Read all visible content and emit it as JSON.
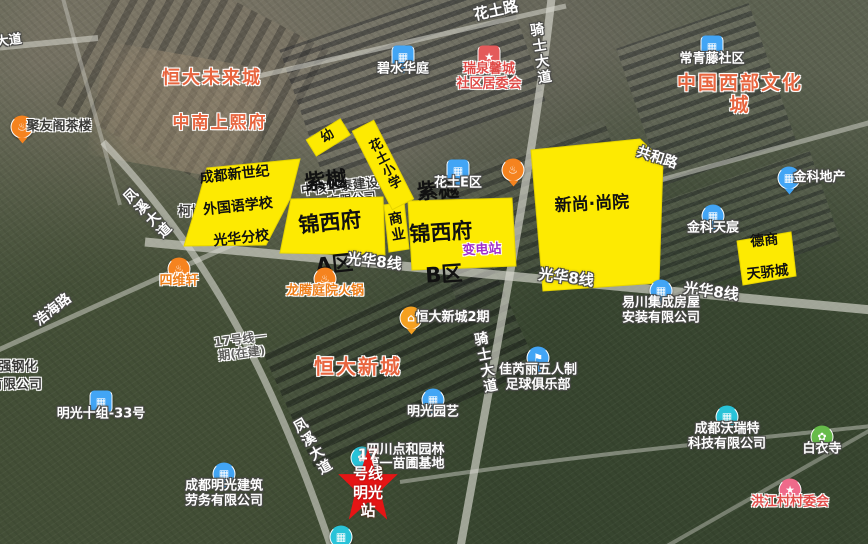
{
  "colors": {
    "parcel_yellow": "#fdea02",
    "road": "#d8d8d0",
    "star_red": "#e51515",
    "poi_blue": "#42a5f5",
    "poi_orange": "#f5831f",
    "poi_teal": "#29c3d8",
    "poi_green": "#66bb4a",
    "poi_pink": "#ef6a8a",
    "poi_red": "#e45a5a",
    "area_red": "#e8653f"
  },
  "parcels": {
    "school": {
      "lines": [
        "成都新世纪",
        "外国语学校",
        "光华分校"
      ]
    },
    "zone_a": {
      "lines": [
        "紫樾",
        "锦西府",
        "A区"
      ]
    },
    "zone_b": {
      "lines": [
        "紫樾",
        "锦西府",
        "B区"
      ]
    },
    "xinshang": {
      "label": "新尚·尚院"
    },
    "deshang": {
      "lines": [
        "德商",
        "天骄城"
      ]
    },
    "shangye": {
      "label": "商业"
    },
    "kindergarten": {
      "label": "幼"
    },
    "huatu_primary": {
      "label": "花土小学"
    },
    "substation": {
      "label": "变电站"
    }
  },
  "station": {
    "label": "17号线\n明光站"
  },
  "construction_note": {
    "label": "17号线一\n期(在建)"
  },
  "area_labels": [
    {
      "text": "恒大未来城",
      "x": 212,
      "y": 79,
      "size": 18
    },
    {
      "text": "中南上熙府",
      "x": 220,
      "y": 124,
      "size": 17
    },
    {
      "text": "中国西部文化城",
      "x": 740,
      "y": 95,
      "size": 19
    },
    {
      "text": "恒大新城",
      "x": 358,
      "y": 367,
      "size": 20
    }
  ],
  "road_labels": [
    {
      "text": "大道",
      "x": 9,
      "y": 42,
      "rot": -8,
      "size": 13
    },
    {
      "text": "花土路",
      "x": 496,
      "y": 11,
      "rot": -12,
      "size": 15
    },
    {
      "text": "骑士大道",
      "x": 540,
      "y": 54,
      "rot": -9,
      "vert": true
    },
    {
      "text": "骑士大道",
      "x": 485,
      "y": 363,
      "rot": -11,
      "vert": true
    },
    {
      "text": "凤溪大道",
      "x": 147,
      "y": 214,
      "rot": -44,
      "vert": true
    },
    {
      "text": "凤溪大道",
      "x": 312,
      "y": 447,
      "rot": -30,
      "vert": true
    },
    {
      "text": "浩海路",
      "x": 53,
      "y": 310,
      "rot": -38,
      "size": 14
    },
    {
      "text": "共和路",
      "x": 657,
      "y": 158,
      "rot": 18,
      "size": 14
    },
    {
      "text": "光华8线",
      "x": 374,
      "y": 262,
      "rot": 6,
      "size": 15
    },
    {
      "text": "光华8线",
      "x": 566,
      "y": 278,
      "rot": 7,
      "size": 15
    },
    {
      "text": "光华8线",
      "x": 711,
      "y": 292,
      "rot": 7,
      "size": 15
    }
  ],
  "fragments": [
    {
      "text": "中核华泰建设",
      "x": 340,
      "y": 188,
      "rot": -6,
      "size": 13,
      "under": true
    },
    {
      "text": "有限公司",
      "x": 352,
      "y": 200,
      "rot": -6,
      "size": 12,
      "under": true
    },
    {
      "text": "柯博",
      "x": 191,
      "y": 213,
      "rot": 0,
      "size": 13,
      "under": true
    },
    {
      "text": "强钢化",
      "x": 18,
      "y": 368,
      "rot": 0,
      "size": 13,
      "under": false
    },
    {
      "text": "有限公司",
      "x": 16,
      "y": 386,
      "rot": 0,
      "size": 13,
      "under": false
    }
  ],
  "pois": [
    {
      "name": "juyouge-teahouse",
      "icon": "tea-icon",
      "shape": "circle",
      "color": "#f5831f",
      "x": 22,
      "y": 127,
      "label": "聚友阁茶楼",
      "lpos": "right",
      "lcolor": "dark"
    },
    {
      "name": "bishui-huating",
      "icon": "building-icon",
      "shape": "rsq",
      "color": "#42a5f5",
      "x": 403,
      "y": 57,
      "label": "碧水华庭",
      "lpos": "below",
      "lcolor": "white"
    },
    {
      "name": "ruiquan-community-committee",
      "icon": "star-icon",
      "shape": "rsq",
      "color": "#e45a5a",
      "x": 489,
      "y": 57,
      "label": "瑞泉馨城\n社区居委会",
      "lpos": "below",
      "lcolor": "red"
    },
    {
      "name": "changqingteng-community",
      "icon": "building-icon",
      "shape": "rsq",
      "color": "#42a5f5",
      "x": 712,
      "y": 47,
      "label": "常青藤社区",
      "lpos": "below",
      "lcolor": "white"
    },
    {
      "name": "jinke-dichan",
      "icon": "shop-icon",
      "shape": "circle",
      "color": "#42a5f5",
      "x": 789,
      "y": 178,
      "label": "金科地产",
      "lpos": "right",
      "lcolor": "white"
    },
    {
      "name": "jinke-tianchen",
      "icon": "building-icon",
      "shape": "circle",
      "color": "#42a5f5",
      "x": 713,
      "y": 216,
      "label": "金科天宸",
      "lpos": "below",
      "lcolor": "white"
    },
    {
      "name": "huatu-e-zone",
      "icon": "building-icon",
      "shape": "rsq",
      "color": "#42a5f5",
      "x": 458,
      "y": 171,
      "label": "花土E区",
      "lpos": "below",
      "lcolor": "white"
    },
    {
      "name": "restaurant-poi",
      "icon": "food-icon",
      "shape": "circle",
      "color": "#f5831f",
      "x": 513,
      "y": 170,
      "label": "",
      "lpos": "below",
      "lcolor": "white"
    },
    {
      "name": "siweixuan",
      "icon": "food-icon",
      "shape": "circle",
      "color": "#f5831f",
      "x": 179,
      "y": 269,
      "label": "四维轩",
      "lpos": "below",
      "lcolor": "orange"
    },
    {
      "name": "longteng-hotpot",
      "icon": "food-icon",
      "shape": "circle",
      "color": "#f5831f",
      "x": 325,
      "y": 279,
      "label": "龙腾庭院火锅",
      "lpos": "below",
      "lcolor": "orange"
    },
    {
      "name": "hengda-xincheng-2",
      "icon": "house-icon",
      "shape": "circle",
      "color": "#f5a021",
      "x": 411,
      "y": 318,
      "label": "恒大新城2期",
      "lpos": "right",
      "lcolor": "white"
    },
    {
      "name": "minguang-yuanyi",
      "icon": "building-icon",
      "shape": "circle",
      "color": "#42a5f5",
      "x": 433,
      "y": 400,
      "label": "明光园艺",
      "lpos": "below",
      "lcolor": "white"
    },
    {
      "name": "jiaruili-football",
      "icon": "flag-icon",
      "shape": "circle",
      "color": "#42a5f5",
      "x": 538,
      "y": 358,
      "label": "佳芮丽五人制\n足球俱乐部",
      "lpos": "below",
      "lcolor": "white"
    },
    {
      "name": "yichuan-housing",
      "icon": "building-icon",
      "shape": "circle",
      "color": "#42a5f5",
      "x": 661,
      "y": 291,
      "label": "易川集成房屋\n安装有限公司",
      "lpos": "below",
      "lcolor": "white"
    },
    {
      "name": "minguang-labor",
      "icon": "building-icon",
      "shape": "circle",
      "color": "#42a5f5",
      "x": 224,
      "y": 474,
      "label": "成都明光建筑\n劳务有限公司",
      "lpos": "below",
      "lcolor": "white"
    },
    {
      "name": "minguang-10-33",
      "icon": "building-icon",
      "shape": "rsq",
      "color": "#42a5f5",
      "x": 101,
      "y": 402,
      "label": "明光十组-33号",
      "lpos": "below",
      "lcolor": "white"
    },
    {
      "name": "wote-tech",
      "icon": "building-icon",
      "shape": "circle",
      "color": "#29c3d8",
      "x": 727,
      "y": 417,
      "label": "成都沃瑞特\n科技有限公司",
      "lpos": "below",
      "lcolor": "white"
    },
    {
      "name": "baiyi-temple",
      "icon": "flower-icon",
      "shape": "circle",
      "color": "#66bb4a",
      "x": 822,
      "y": 437,
      "label": "白衣寺",
      "lpos": "below",
      "lcolor": "white"
    },
    {
      "name": "hongjiang-committee",
      "icon": "star-icon",
      "shape": "circle",
      "color": "#ef6a8a",
      "x": 790,
      "y": 490,
      "label": "洪江村村委会",
      "lpos": "below",
      "lcolor": "red"
    },
    {
      "name": "dianhe-nursery",
      "icon": "flower-icon",
      "shape": "circle",
      "color": "#29c3d8",
      "x": 362,
      "y": 458,
      "label": "四川点和园林\n第一苗圃基地",
      "lpos": "right",
      "lcolor": "white"
    },
    {
      "name": "edge-poi",
      "icon": "building-icon",
      "shape": "circle",
      "color": "#29c3d8",
      "x": 341,
      "y": 537,
      "label": "",
      "lpos": "below",
      "lcolor": "white"
    }
  ]
}
